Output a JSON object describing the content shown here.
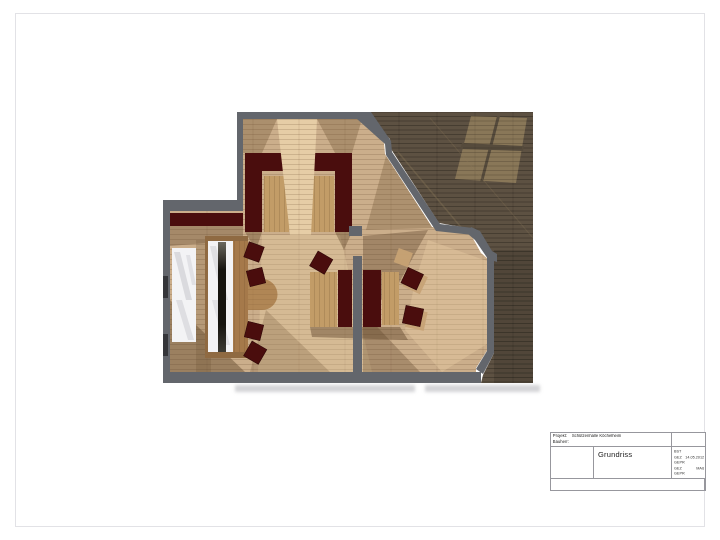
{
  "title_block": {
    "project_label": "Projekt:",
    "project_value": "Schützenhalle Köchelheim",
    "client_label": "Bauherr:",
    "drawing_title": "Grundriss",
    "fields": [
      {
        "label": "BST",
        "value": ""
      },
      {
        "label": "GEZ",
        "value": "14.05.2012"
      },
      {
        "label": "GEPR",
        "value": ""
      },
      {
        "label": "GEZ",
        "value": "MAß"
      },
      {
        "label": "GEPR",
        "value": ""
      }
    ]
  },
  "plan": {
    "colors": {
      "page": "#ffffff",
      "wall": "#63666c",
      "floor_light": "#cbae8b",
      "floor_dark_outer": "#5d5142",
      "bench_red": "#4a0d0d",
      "table_wood": "#c29c67",
      "counter_wood": "#a5794a",
      "stairs_white": "#f3f3f5",
      "bar_dark": "#17150f",
      "light_patch": "#8e7b5b"
    }
  }
}
